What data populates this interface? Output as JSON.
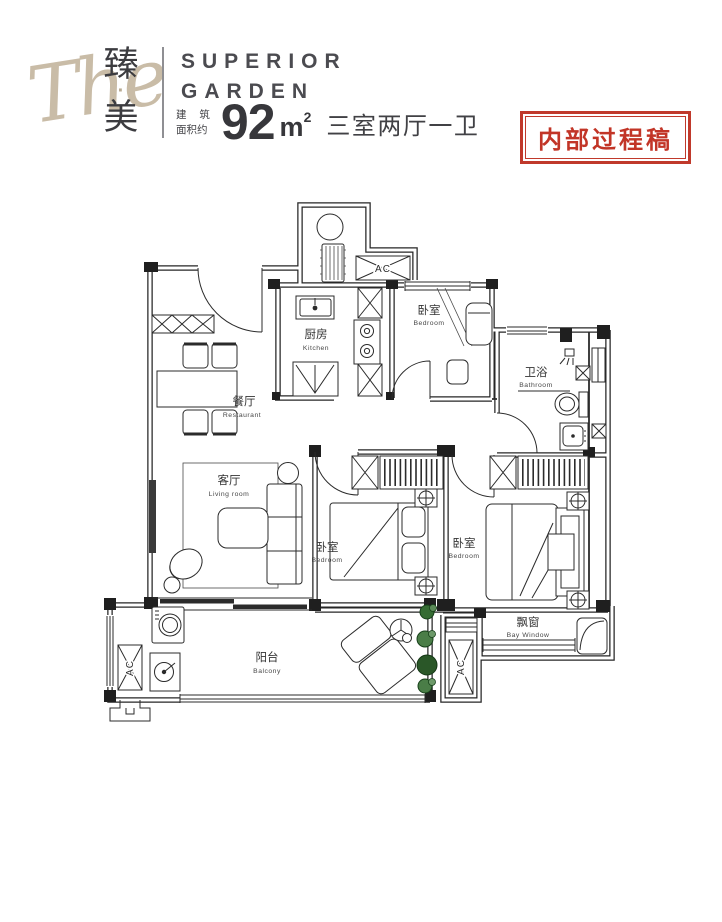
{
  "header": {
    "logo_script": "The",
    "logo_cn_top": "臻",
    "logo_cn_dot": "·",
    "logo_cn_bottom": "美",
    "brand_line1": "SUPERIOR",
    "brand_line2": "GARDEN",
    "area_label_line1": "建 筑",
    "area_label_line2": "面积约",
    "area_value": "92",
    "area_unit": "m",
    "area_unit_sup": "2",
    "layout_text": "三室两厅一卫",
    "stamp_text": "内部过程稿"
  },
  "plan": {
    "rooms": {
      "kitchen": {
        "cn": "厨房",
        "en": "Kitchen"
      },
      "bedroom_top": {
        "cn": "卧室",
        "en": "Bedroom"
      },
      "bathroom": {
        "cn": "卫浴",
        "en": "Bathroom"
      },
      "dining": {
        "cn": "餐厅",
        "en": "Restaurant"
      },
      "living": {
        "cn": "客厅",
        "en": "Living room"
      },
      "bedroom_middle": {
        "cn": "卧室",
        "en": "Bedroom"
      },
      "bedroom_master": {
        "cn": "卧室",
        "en": "Bedroom"
      },
      "balcony": {
        "cn": "阳台",
        "en": "Balcony"
      },
      "bay_window": {
        "cn": "飘窗",
        "en": "Bay Window"
      }
    },
    "ac_label": "AC"
  },
  "colors": {
    "stamp_red": "#c0392b",
    "logo_beige": "#c9bca7",
    "line_dark": "#262626",
    "plant_green": "#356c33"
  }
}
